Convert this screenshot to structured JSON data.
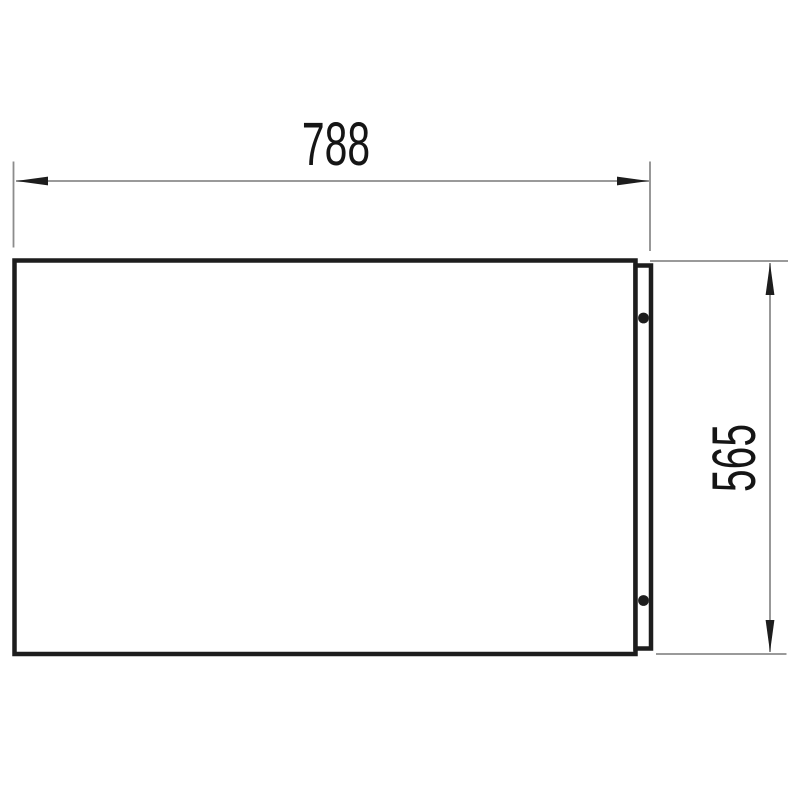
{
  "drawing": {
    "type": "technical-dimension-drawing",
    "subject": "rectangular panel front view with right mounting flange and two screw holes",
    "width_dimension": {
      "label": "788"
    },
    "height_dimension": {
      "label": "565"
    },
    "screw_hole_count": 2,
    "colors": {
      "thick_line": "#1d1d1d",
      "thin_line": "#8c8c8c",
      "background": "#ffffff"
    }
  }
}
